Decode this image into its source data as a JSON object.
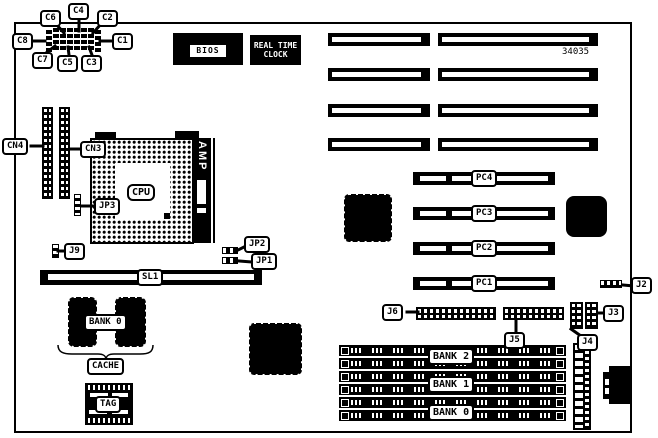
{
  "board": {
    "part_number": "34035"
  },
  "chips": {
    "bios": "BIOS",
    "rtc_line1": "REAL TIME",
    "rtc_line2": "CLOCK",
    "cpu": "CPU",
    "amp": "AMP",
    "sl1": "SL1",
    "cache_bank": "BANK 0",
    "cache": "CACHE",
    "tag": "TAG"
  },
  "callouts": {
    "c1": "C1",
    "c2": "C2",
    "c3": "C3",
    "c4": "C4",
    "c5": "C5",
    "c6": "C6",
    "c7": "C7",
    "c8": "C8",
    "cn3": "CN3",
    "cn4": "CN4",
    "jp1": "JP1",
    "jp2": "JP2",
    "jp3": "JP3",
    "j2": "J2",
    "j3": "J3",
    "j4": "J4",
    "j5": "J5",
    "j6": "J6",
    "j9": "J9"
  },
  "slots": {
    "pci": [
      "PC4",
      "PC3",
      "PC2",
      "PC1"
    ]
  },
  "memory": {
    "banks": [
      "BANK 2",
      "BANK 1",
      "BANK 0"
    ]
  }
}
